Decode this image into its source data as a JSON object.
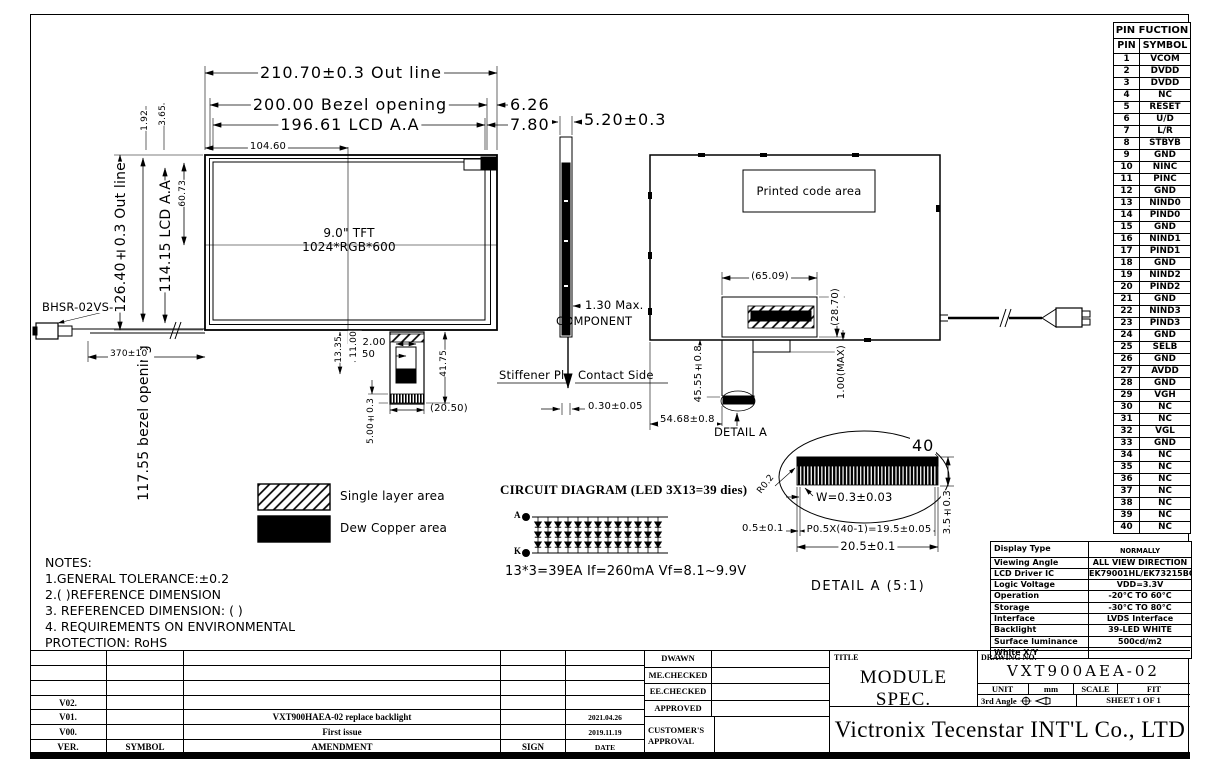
{
  "page": {
    "background": "#ffffff",
    "line_color": "#000000"
  },
  "pin_table": {
    "title": "PIN FUCTION",
    "columns": [
      "PIN",
      "SYMBOL"
    ],
    "rows": [
      [
        "1",
        "VCOM"
      ],
      [
        "2",
        "DVDD"
      ],
      [
        "3",
        "DVDD"
      ],
      [
        "4",
        "NC"
      ],
      [
        "5",
        "RESET"
      ],
      [
        "6",
        "U/D"
      ],
      [
        "7",
        "L/R"
      ],
      [
        "8",
        "STBYB"
      ],
      [
        "9",
        "GND"
      ],
      [
        "10",
        "NINC"
      ],
      [
        "11",
        "PINC"
      ],
      [
        "12",
        "GND"
      ],
      [
        "13",
        "NIND0"
      ],
      [
        "14",
        "PIND0"
      ],
      [
        "15",
        "GND"
      ],
      [
        "16",
        "NIND1"
      ],
      [
        "17",
        "PIND1"
      ],
      [
        "18",
        "GND"
      ],
      [
        "19",
        "NIND2"
      ],
      [
        "20",
        "PIND2"
      ],
      [
        "21",
        "GND"
      ],
      [
        "22",
        "NIND3"
      ],
      [
        "23",
        "PIND3"
      ],
      [
        "24",
        "GND"
      ],
      [
        "25",
        "SELB"
      ],
      [
        "26",
        "GND"
      ],
      [
        "27",
        "AVDD"
      ],
      [
        "28",
        "GND"
      ],
      [
        "29",
        "VGH"
      ],
      [
        "30",
        "NC"
      ],
      [
        "31",
        "NC"
      ],
      [
        "32",
        "VGL"
      ],
      [
        "33",
        "GND"
      ],
      [
        "34",
        "NC"
      ],
      [
        "35",
        "NC"
      ],
      [
        "36",
        "NC"
      ],
      [
        "37",
        "NC"
      ],
      [
        "38",
        "NC"
      ],
      [
        "39",
        "NC"
      ],
      [
        "40",
        "NC"
      ]
    ]
  },
  "spec_table": {
    "rows": [
      [
        "Display Type",
        "NORMALLY BLACK,TRANSMISSIVE"
      ],
      [
        "Viewing Angle",
        "ALL VIEW DIRECTION"
      ],
      [
        "LCD Driver IC",
        "EK79001HL/EK73215BCGA"
      ],
      [
        "Logic Voltage",
        "VDD=3.3V"
      ],
      [
        "Operation Temperature",
        "-20°C TO 60°C"
      ],
      [
        "Storage Temperature",
        "-30°C TO 80°C"
      ],
      [
        "Interface",
        "LVDS Interface"
      ],
      [
        "Backlight",
        "39-LED WHITE"
      ],
      [
        "Surface luminance",
        "500cd/m2"
      ],
      [
        "White X/Y",
        ""
      ]
    ]
  },
  "revision_table": {
    "headers": [
      "VER.",
      "SYMBOL",
      "AMENDMENT",
      "SIGN",
      "DATE"
    ],
    "rows": [
      [
        "",
        "",
        "",
        "",
        ""
      ],
      [
        "",
        "",
        "",
        "",
        ""
      ],
      [
        "",
        "",
        "",
        "",
        ""
      ],
      [
        "V02.",
        "",
        "",
        "",
        ""
      ],
      [
        "V01.",
        "",
        "VXT900HAEA-02 replace backlight",
        "",
        "2021.04.26"
      ],
      [
        "V00.",
        "",
        "First issue",
        "",
        "2019.11.19"
      ]
    ]
  },
  "approval": {
    "rows": [
      "DWAWN",
      "ME.CHECKED",
      "EE.CHECKED",
      "APPROVED"
    ],
    "customer": "CUSTOMER'S APPROVAL"
  },
  "title_block": {
    "title_label": "TITLE",
    "title": "MODULE  SPEC.",
    "drawing_no_label": "DRAWING NO.",
    "drawing_no": "VXT900AEA-02",
    "unit_label": "UNIT",
    "unit_value": "mm",
    "scale_label": "SCALE",
    "scale_value": "FIT",
    "angle_label": "3rd Angle",
    "sheet": "SHEET 1 OF 1",
    "company": "Victronix Tecenstar INT'L Co., LTD"
  },
  "drawing": {
    "front": {
      "dim_outline": "210.70±0.3 Out line",
      "dim_bezel": "200.00 Bezel opening",
      "dim_aa": "196.61 LCD A.A",
      "dim_right_top": "6.26",
      "dim_right_bottom": "7.80",
      "dim_half": "104.60",
      "dim_v_outline": "126.40±0.3 Out line",
      "dim_v_aa": "114.15 LCD A.A",
      "dim_v_bezel": "117.55 bezel opening",
      "dim_192": "1.92",
      "dim_365": "3.65",
      "dim_6073": "60.73",
      "screen_line1": "9.0\" TFT",
      "screen_line2": "1024*RGB*600",
      "connector_label": "BHSR-02VS-",
      "dim_wire": "370±10"
    },
    "fpc": {
      "dim_1200": "12.00",
      "dim_450": "4.50",
      "dim_1100": "11.00",
      "dim_1335": "13.35",
      "dim_4175": "41.75",
      "dim_2050": "(20.50)",
      "dim_500": "5.00±0.3"
    },
    "side": {
      "dim_thickness": "5.20±0.3",
      "component_line1": "1.30 Max.",
      "component_line2": "COMPONENT",
      "stiffener": "Stiffener Pl",
      "contact": "Contact Side",
      "dim_030": "0.30±0.05"
    },
    "rear": {
      "printed_code": "Printed code area",
      "dim_6509": "(65.09)",
      "dim_2870": "(28.70)",
      "dim_4555": "45.55±0.8",
      "dim_100max": "1.00(MAX)",
      "dim_5468": "54.68±0.8",
      "detail_label": "DETAIL A"
    },
    "detail_a": {
      "pin_count": "40",
      "dim_r": "R0.2",
      "dim_w": "W=0.3±0.03",
      "dim_05": "0.5±0.1",
      "dim_pitch": "P0.5X(40-1)=19.5±0.05",
      "dim_205": "20.5±0.1",
      "dim_35": "3.5±0.3",
      "caption": "DETAIL A (5:1)"
    },
    "legend": {
      "single_layer": "Single layer area",
      "dew_copper": "Dew Copper area"
    },
    "circuit": {
      "title": "CIRCUIT DIAGRAM (LED 3X13=39  dies)",
      "anode": "A",
      "cathode": "K",
      "spec": "13*3=39EA   If=260mA  Vf=8.1~9.9V",
      "columns": 13,
      "rows": 3
    },
    "notes": [
      "NOTES:",
      "1.GENERAL TOLERANCE:±0.2",
      "2.(   )REFERENCE DIMENSION",
      "3. REFERENCED DIMENSION: (    )",
      "4. REQUIREMENTS ON ENVIRONMENTAL",
      "PROTECTION: RoHS"
    ]
  }
}
